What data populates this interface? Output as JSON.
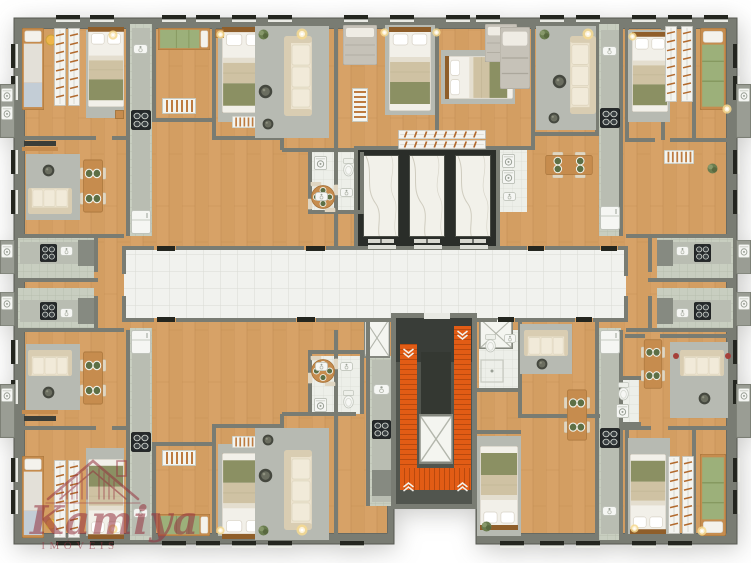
{
  "watermark": {
    "brand": "Kamiya",
    "subtitle": "IMÓVEIS"
  },
  "palette": {
    "background": "#ffffff",
    "wall": "#797c73",
    "wallDark": "#565951",
    "lintel": "#24261f",
    "wood": "#d7a267",
    "woodDark": "#b9854a",
    "rug": "#b7bab2",
    "rugDark": "#a3a69e",
    "corridor": "#f1f2ee",
    "tileLine": "#d9dbd4",
    "bathTile": "#edefe9",
    "kitchenTile": "#c8cec0",
    "kitchenLine": "#b3baa9",
    "marble": "#f2f1ea",
    "marbleVein": "#c7c3b4",
    "elevatorFrame": "#2a2d29",
    "stairFloor": "#51554e",
    "stairDark": "#393d38",
    "stairOrange": "#e25c15",
    "stairTread": "#b8490e",
    "sofa": "#ebe2cd",
    "sofaDark": "#d9cdb2",
    "bedWhite": "#f2f0e9",
    "bedBeige": "#cfc2a3",
    "bedOlive": "#8b9063",
    "bedGreen": "#9cb07a",
    "bedGray": "#c6c2b8",
    "woodFurn": "#c68c4e",
    "woodFurnDark": "#8f5e2a",
    "plate": "#5d6f45",
    "appliance": "#25292b",
    "fixture": "#f5f6f3",
    "counter": "#b9bdb2",
    "accentWarm": "#eeb54b",
    "glow": "#f6d98f",
    "brand": "#95323f"
  }
}
